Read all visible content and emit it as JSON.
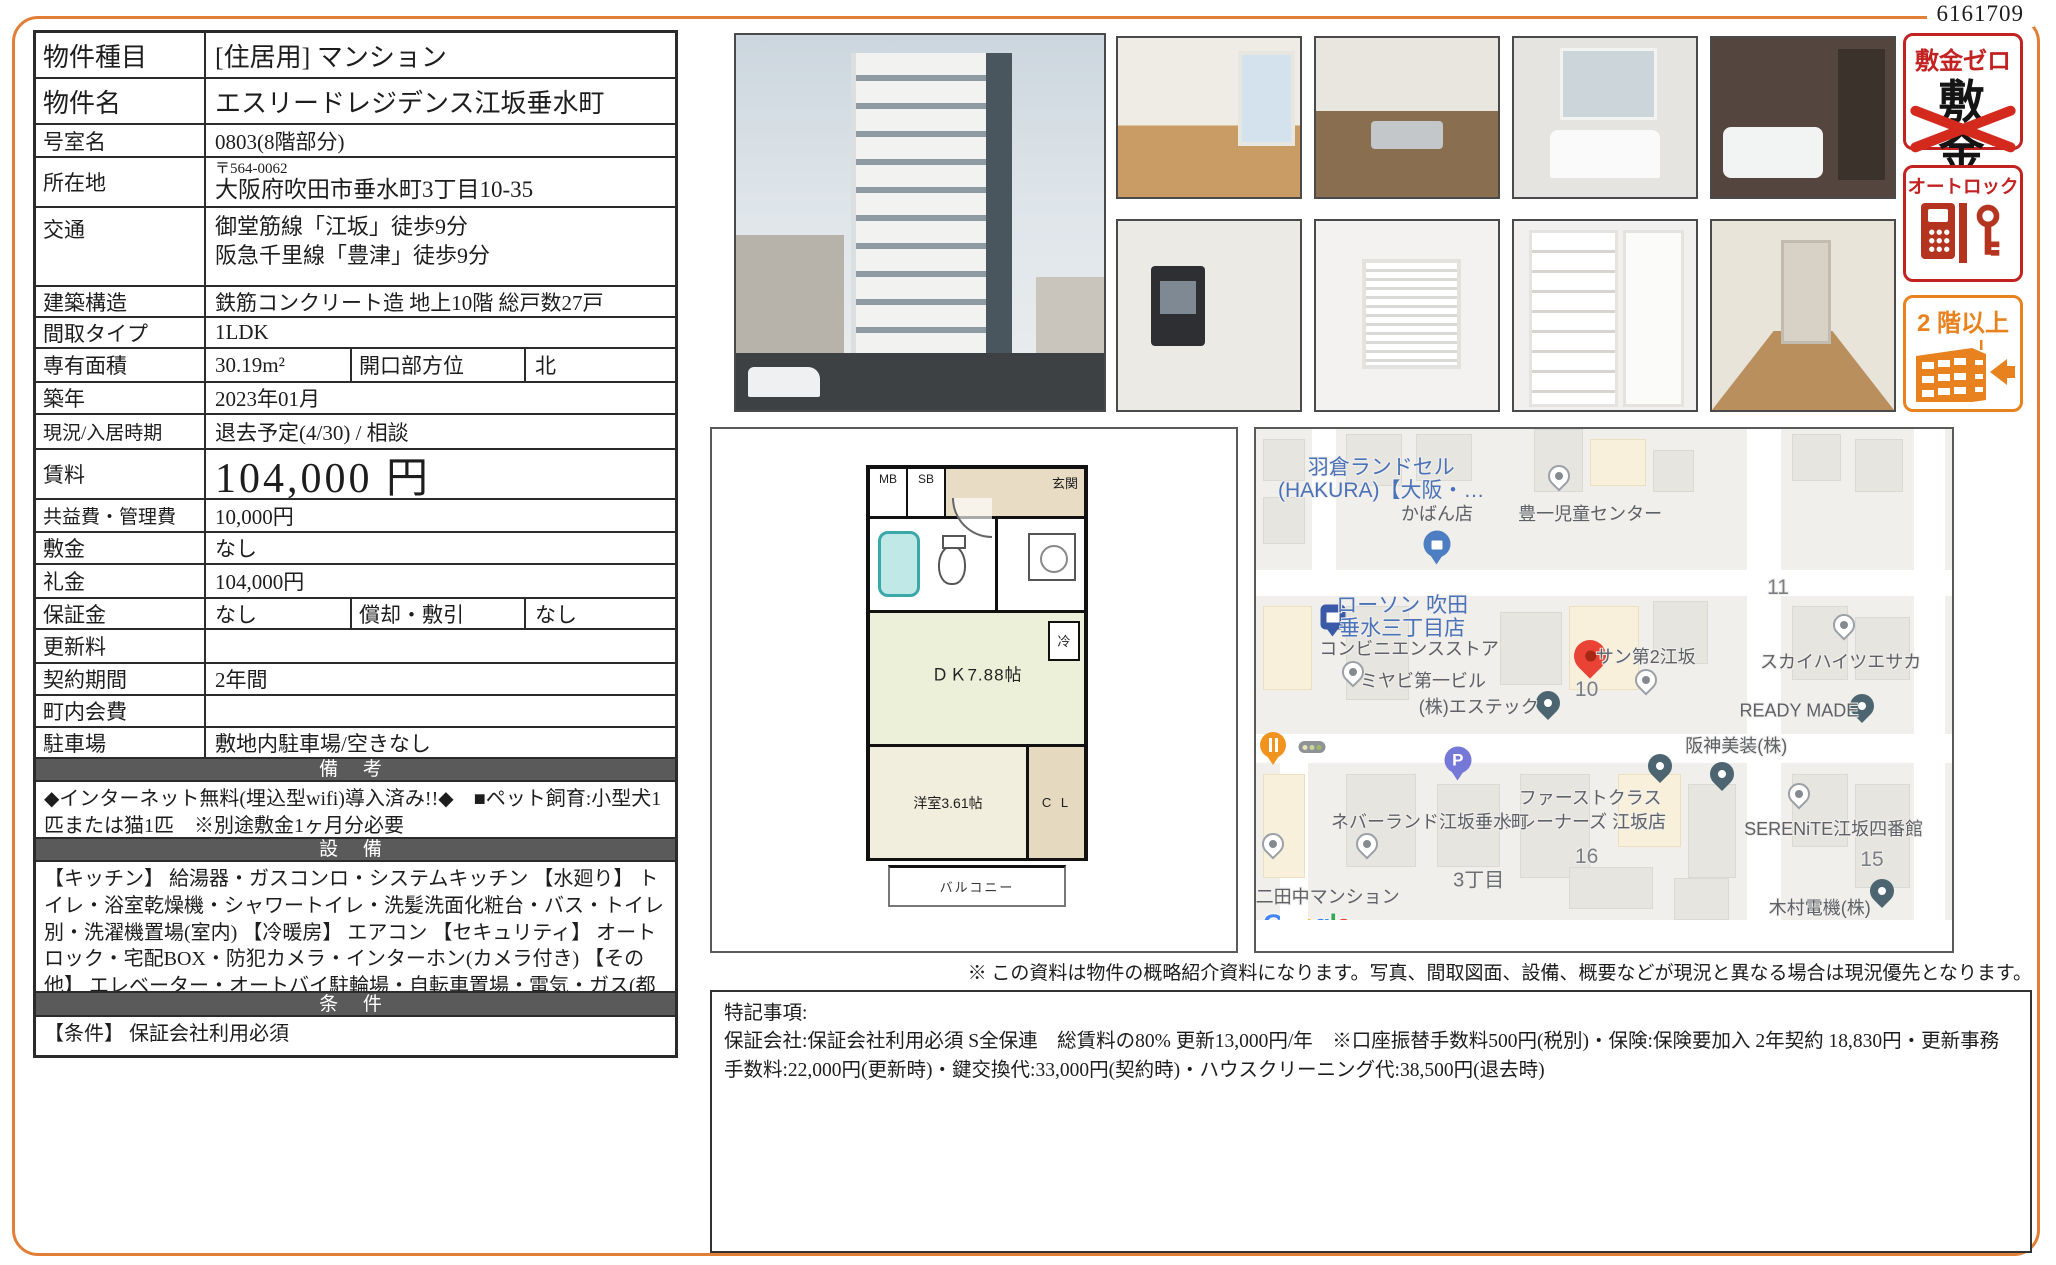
{
  "doc_number": "6161709",
  "colors": {
    "page_border": "#e07f35",
    "section_bar": "#5a5a5a",
    "badge_red": "#c32222",
    "badge_cross_red": "#d42a1e",
    "badge_orange": "#e8821e",
    "map_red_pin": "#ea4335",
    "map_blue_label": "#4a72b8"
  },
  "table": {
    "property_type": {
      "label": "物件種目",
      "value": "[住居用] マンション"
    },
    "property_name": {
      "label": "物件名",
      "value": "エスリードレジデンス江坂垂水町"
    },
    "room": {
      "label": "号室名",
      "value": "0803(8階部分)"
    },
    "address": {
      "label": "所在地",
      "postal": "〒564-0062",
      "value": "大阪府吹田市垂水町3丁目10-35"
    },
    "transit": {
      "label": "交通",
      "lines": [
        "御堂筋線「江坂」徒歩9分",
        "阪急千里線「豊津」徒歩9分"
      ]
    },
    "structure": {
      "label": "建築構造",
      "value": "鉄筋コンクリート造 地上10階 総戸数27戸"
    },
    "layout": {
      "label": "間取タイプ",
      "value": "1LDK"
    },
    "area": {
      "label": "専有面積",
      "value": "30.19m²",
      "label2": "開口部方位",
      "value2": "北"
    },
    "built": {
      "label": "築年",
      "value": "2023年01月"
    },
    "status": {
      "label": "現況/入居時期",
      "value": "退去予定(4/30) / 相談"
    },
    "rent": {
      "label": "賃料",
      "value": "104,000 円"
    },
    "maintenance": {
      "label": "共益費・管理費",
      "value": "10,000円"
    },
    "deposit": {
      "label": "敷金",
      "value": "なし"
    },
    "key_money": {
      "label": "礼金",
      "value": "104,000円"
    },
    "guarantee": {
      "label": "保証金",
      "value": "なし",
      "label2": "償却・敷引",
      "value2": "なし"
    },
    "renewal": {
      "label": "更新料",
      "value": ""
    },
    "term": {
      "label": "契約期間",
      "value": "2年間"
    },
    "town_fee": {
      "label": "町内会費",
      "value": ""
    },
    "parking": {
      "label": "駐車場",
      "value": "敷地内駐車場/空きなし"
    },
    "remarks": {
      "header": "備 考",
      "text": "◆インターネット無料(埋込型wifi)導入済み!!◆　■ペット飼育:小型犬1匹または猫1匹　※別途敷金1ヶ月分必要"
    },
    "equipment": {
      "header": "設 備",
      "text": "【キッチン】 給湯器・ガスコンロ・システムキッチン 【水廻り】 トイレ・浴室乾燥機・シャワートイレ・洗髪洗面化粧台・バス・トイレ別・洗濯機置場(室内) 【冷暖房】 エアコン 【セキュリティ】 オートロック・宅配BOX・防犯カメラ・インターホン(カメラ付き) 【その他】 エレベーター・オートバイ駐輪場・自転車置場・電気・ガス(都市ガス)・バルコニー/ベランダ・フローリング"
    },
    "conditions": {
      "header": "条 件",
      "text": "【条件】 保証会社利用必須"
    }
  },
  "photos": {
    "main": "building-exterior",
    "thumbs": [
      "room",
      "kitchen",
      "washstand",
      "bathroom",
      "intercom",
      "ventilation",
      "shoe-storage",
      "hallway"
    ]
  },
  "badges": {
    "no_deposit": {
      "title": "敷金ゼロ",
      "crossed": "敷金"
    },
    "autolock": {
      "title": "オートロック"
    },
    "upper_floor": {
      "title": "2 階以上"
    }
  },
  "floorplan": {
    "mb": "MB",
    "sb": "SB",
    "entrance": "玄関",
    "dk": "ＤＫ7.88帖",
    "fridge": "冷",
    "western_room": "洋室3.61帖",
    "closet": "C L",
    "balcony": "バルコニー"
  },
  "map": {
    "labels": [
      {
        "text": "羽倉ランドセル",
        "x": 18,
        "y": 7,
        "cls": "blue"
      },
      {
        "text": "(HAKURA)【大阪・…",
        "x": 18,
        "y": 11.5,
        "cls": "blue"
      },
      {
        "text": "かばん店",
        "x": 26,
        "y": 16,
        "cls": ""
      },
      {
        "text": "豊一児童センター",
        "x": 48,
        "y": 16,
        "cls": ""
      },
      {
        "text": "11",
        "x": 75,
        "y": 30.5,
        "cls": "num"
      },
      {
        "text": "ローソン 吹田",
        "x": 21,
        "y": 33.5,
        "cls": "blue"
      },
      {
        "text": "垂水三丁目店",
        "x": 21,
        "y": 38,
        "cls": "blue"
      },
      {
        "text": "コンビニエンスストア",
        "x": 22,
        "y": 42,
        "cls": ""
      },
      {
        "text": "サン第2江坂",
        "x": 56,
        "y": 43.5,
        "cls": ""
      },
      {
        "text": "10",
        "x": 47.5,
        "y": 50,
        "cls": "num"
      },
      {
        "text": "スカイハイツエサカ",
        "x": 84,
        "y": 44.5,
        "cls": ""
      },
      {
        "text": "ミヤビ第一ビル",
        "x": 24,
        "y": 48,
        "cls": ""
      },
      {
        "text": "(株)エステック",
        "x": 32,
        "y": 53,
        "cls": ""
      },
      {
        "text": "READY MADE",
        "x": 78,
        "y": 54,
        "cls": ""
      },
      {
        "text": "阪神美装(株)",
        "x": 69,
        "y": 60.5,
        "cls": ""
      },
      {
        "text": "ファーストクラス",
        "x": 48,
        "y": 70.5,
        "cls": ""
      },
      {
        "text": "トレーナーズ 江坂店",
        "x": 47,
        "y": 75,
        "cls": ""
      },
      {
        "text": "ネバーランド江坂垂水町",
        "x": 25,
        "y": 75,
        "cls": ""
      },
      {
        "text": "SERENiTE江坂四番館",
        "x": 83,
        "y": 76.5,
        "cls": ""
      },
      {
        "text": "16",
        "x": 47.5,
        "y": 82,
        "cls": "num"
      },
      {
        "text": "3丁目",
        "x": 32,
        "y": 86,
        "cls": "area"
      },
      {
        "text": "15",
        "x": 88.5,
        "y": 82.5,
        "cls": "num"
      },
      {
        "text": "第二田中マンション",
        "x": 9,
        "y": 89.5,
        "cls": ""
      },
      {
        "text": "木村電機(株)",
        "x": 81,
        "y": 91.5,
        "cls": ""
      }
    ],
    "pins": [
      {
        "type": "shopping",
        "x": 26,
        "y": 22
      },
      {
        "type": "white",
        "x": 43.5,
        "y": 9
      },
      {
        "type": "lawson",
        "x": 11,
        "y": 36
      },
      {
        "type": "red",
        "x": 48,
        "y": 43.5
      },
      {
        "type": "white",
        "x": 56,
        "y": 48
      },
      {
        "type": "white",
        "x": 84.5,
        "y": 37.5
      },
      {
        "type": "white",
        "x": 14,
        "y": 46.5
      },
      {
        "type": "teal",
        "x": 42,
        "y": 52.5
      },
      {
        "type": "restaurant",
        "x": 2.5,
        "y": 60.5
      },
      {
        "type": "traffic",
        "x": 8,
        "y": 61
      },
      {
        "type": "parking",
        "x": 29,
        "y": 63.5
      },
      {
        "type": "teal",
        "x": 58,
        "y": 64.5
      },
      {
        "type": "teal",
        "x": 67,
        "y": 66
      },
      {
        "type": "teal",
        "x": 87,
        "y": 53
      },
      {
        "type": "white",
        "x": 16,
        "y": 79.5
      },
      {
        "type": "white",
        "x": 78,
        "y": 70
      },
      {
        "type": "white",
        "x": 2.5,
        "y": 79.5
      },
      {
        "type": "teal",
        "x": 90,
        "y": 88.5
      }
    ],
    "google_logo": {
      "text": "Google",
      "colors": [
        "#4285F4",
        "#EA4335",
        "#FBBC05",
        "#4285F4",
        "#34A853",
        "#EA4335"
      ]
    },
    "copyright": "Map data ©2023"
  },
  "map_note": "※ この資料は物件の概略紹介資料になります。写真、間取図面、設備、概要などが現況と異なる場合は現況優先となります。",
  "special_notes": {
    "title": "特記事項:",
    "body": "保証会社:保証会社利用必須 S全保連　総賃料の80% 更新13,000円/年　※口座振替手数料500円(税別)・保険:保険要加入 2年契約 18,830円・更新事務手数料:22,000円(更新時)・鍵交換代:33,000円(契約時)・ハウスクリーニング代:38,500円(退去時)"
  }
}
